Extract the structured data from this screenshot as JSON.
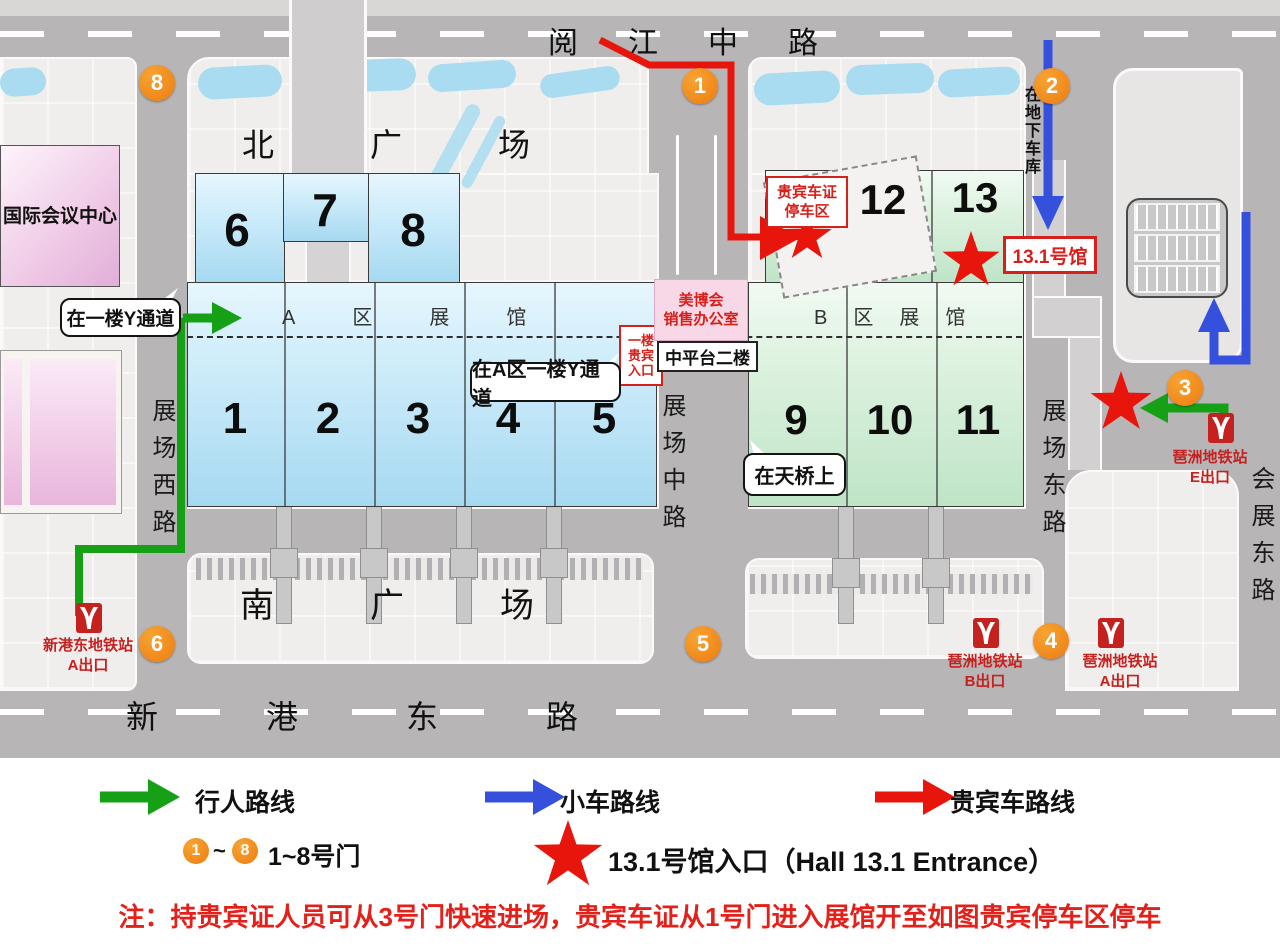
{
  "colors": {
    "route_green": "#16a016",
    "route_blue": "#3450dd",
    "route_red": "#e8150c",
    "gate_orange": "#ec7c10",
    "metro_red": "#c5211f",
    "hall_blue": "#bfe6f8",
    "hall_green": "#cdebd3",
    "note_red": "#e32019"
  },
  "roads": {
    "top": "阅江中路",
    "bottom": "新港东路",
    "west": "展场西路",
    "middle": "展场中路",
    "east": "展场东路",
    "far_east": "会展东路"
  },
  "plazas": {
    "north": "北广场",
    "south": "南广场"
  },
  "buildings": {
    "conference_center": "国际会议中心",
    "zone_a_label": "A区展馆",
    "zone_b_label": "B区展馆",
    "halls_a_upper": [
      "6",
      "7",
      "8"
    ],
    "halls_a": [
      "1",
      "2",
      "3",
      "4",
      "5"
    ],
    "halls_b_upper": [
      "12",
      "13"
    ],
    "halls_b": [
      "9",
      "10",
      "11"
    ],
    "covered_text": "能"
  },
  "callouts": {
    "y_corridor": "在一楼Y通道",
    "a_zone_y_corridor": "在A区一楼Y通道",
    "footbridge": "在天桥上",
    "underground_garage": "在地下车库",
    "vip_entrance": [
      "一楼",
      "贵宾",
      "入口"
    ],
    "vip_parking": [
      "贵宾车证",
      "停车区"
    ],
    "hall_13_1": "13.1号馆",
    "sales_office": [
      "美博会",
      "销售办公室"
    ],
    "mid_platform": "中平台二楼"
  },
  "metro": {
    "xingangdong": {
      "station": "新港东地铁站",
      "exit": "A出口"
    },
    "pazhou_e": {
      "station": "琶洲地铁站",
      "exit": "E出口"
    },
    "pazhou_b": {
      "station": "琶洲地铁站",
      "exit": "B出口"
    },
    "pazhou_a": {
      "station": "琶洲地铁站",
      "exit": "A出口"
    }
  },
  "gates": {
    "g1": "1",
    "g2": "2",
    "g3": "3",
    "g4": "4",
    "g5": "5",
    "g6": "6",
    "g8": "8"
  },
  "legend": {
    "pedestrian": "行人路线",
    "car": "小车路线",
    "vip_car": "贵宾车路线",
    "gate_first": "1",
    "gate_tilde": "~",
    "gate_last": "8",
    "gates_label": "1~8号门",
    "star_label": "13.1号馆入口（Hall 13.1 Entrance）"
  },
  "note": "注：持贵宾证人员可从3号门快速进场，贵宾车证从1号门进入展馆开至如图贵宾停车区停车"
}
